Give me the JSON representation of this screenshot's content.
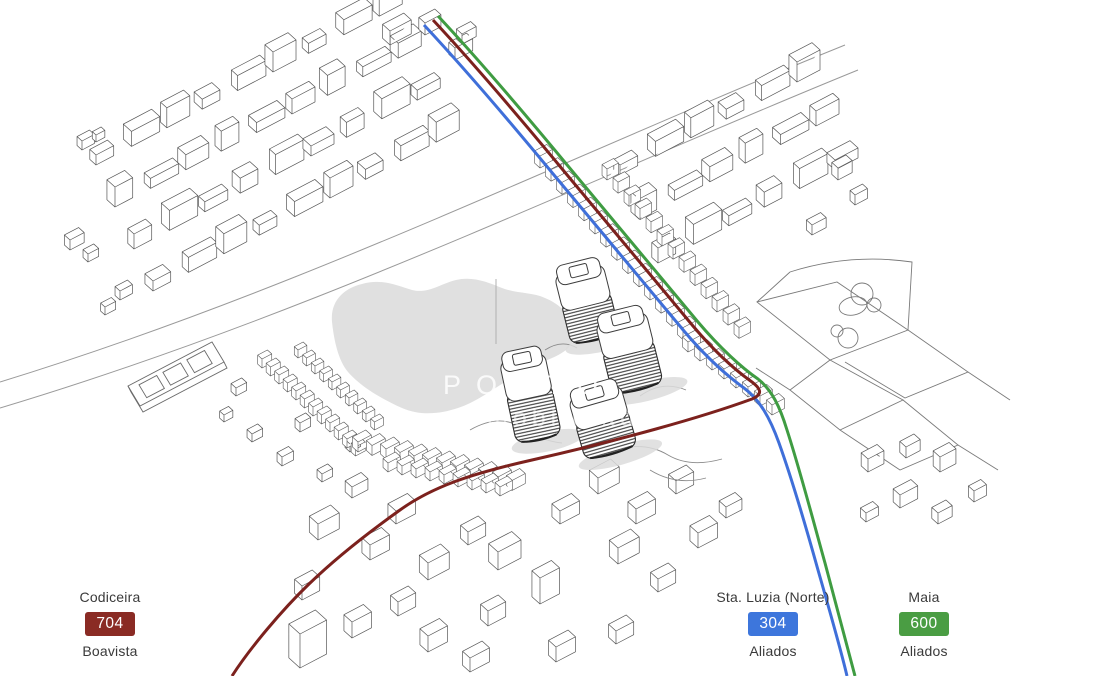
{
  "watermark": {
    "line1": "PORTO",
    "line2": "mobilidade"
  },
  "legend": [
    {
      "from": "Codiceira",
      "line": "704",
      "to": "Boavista",
      "badge_color": "#8a2b24"
    },
    {
      "from": "Sta. Luzia (Norte)",
      "line": "304",
      "to": "Aliados",
      "badge_color": "#3d76dc"
    },
    {
      "from": "Maia",
      "line": "600",
      "to": "Aliados",
      "badge_color": "#4a9d43"
    }
  ],
  "routes": {
    "704": {
      "color": "#7c211d"
    },
    "304": {
      "color": "#3f6fd9"
    },
    "600": {
      "color": "#3f9c42"
    }
  },
  "map_colors": {
    "blob": "#e0e0e0",
    "building_stroke": "#565656",
    "road_stroke": "#9a9a9a"
  }
}
